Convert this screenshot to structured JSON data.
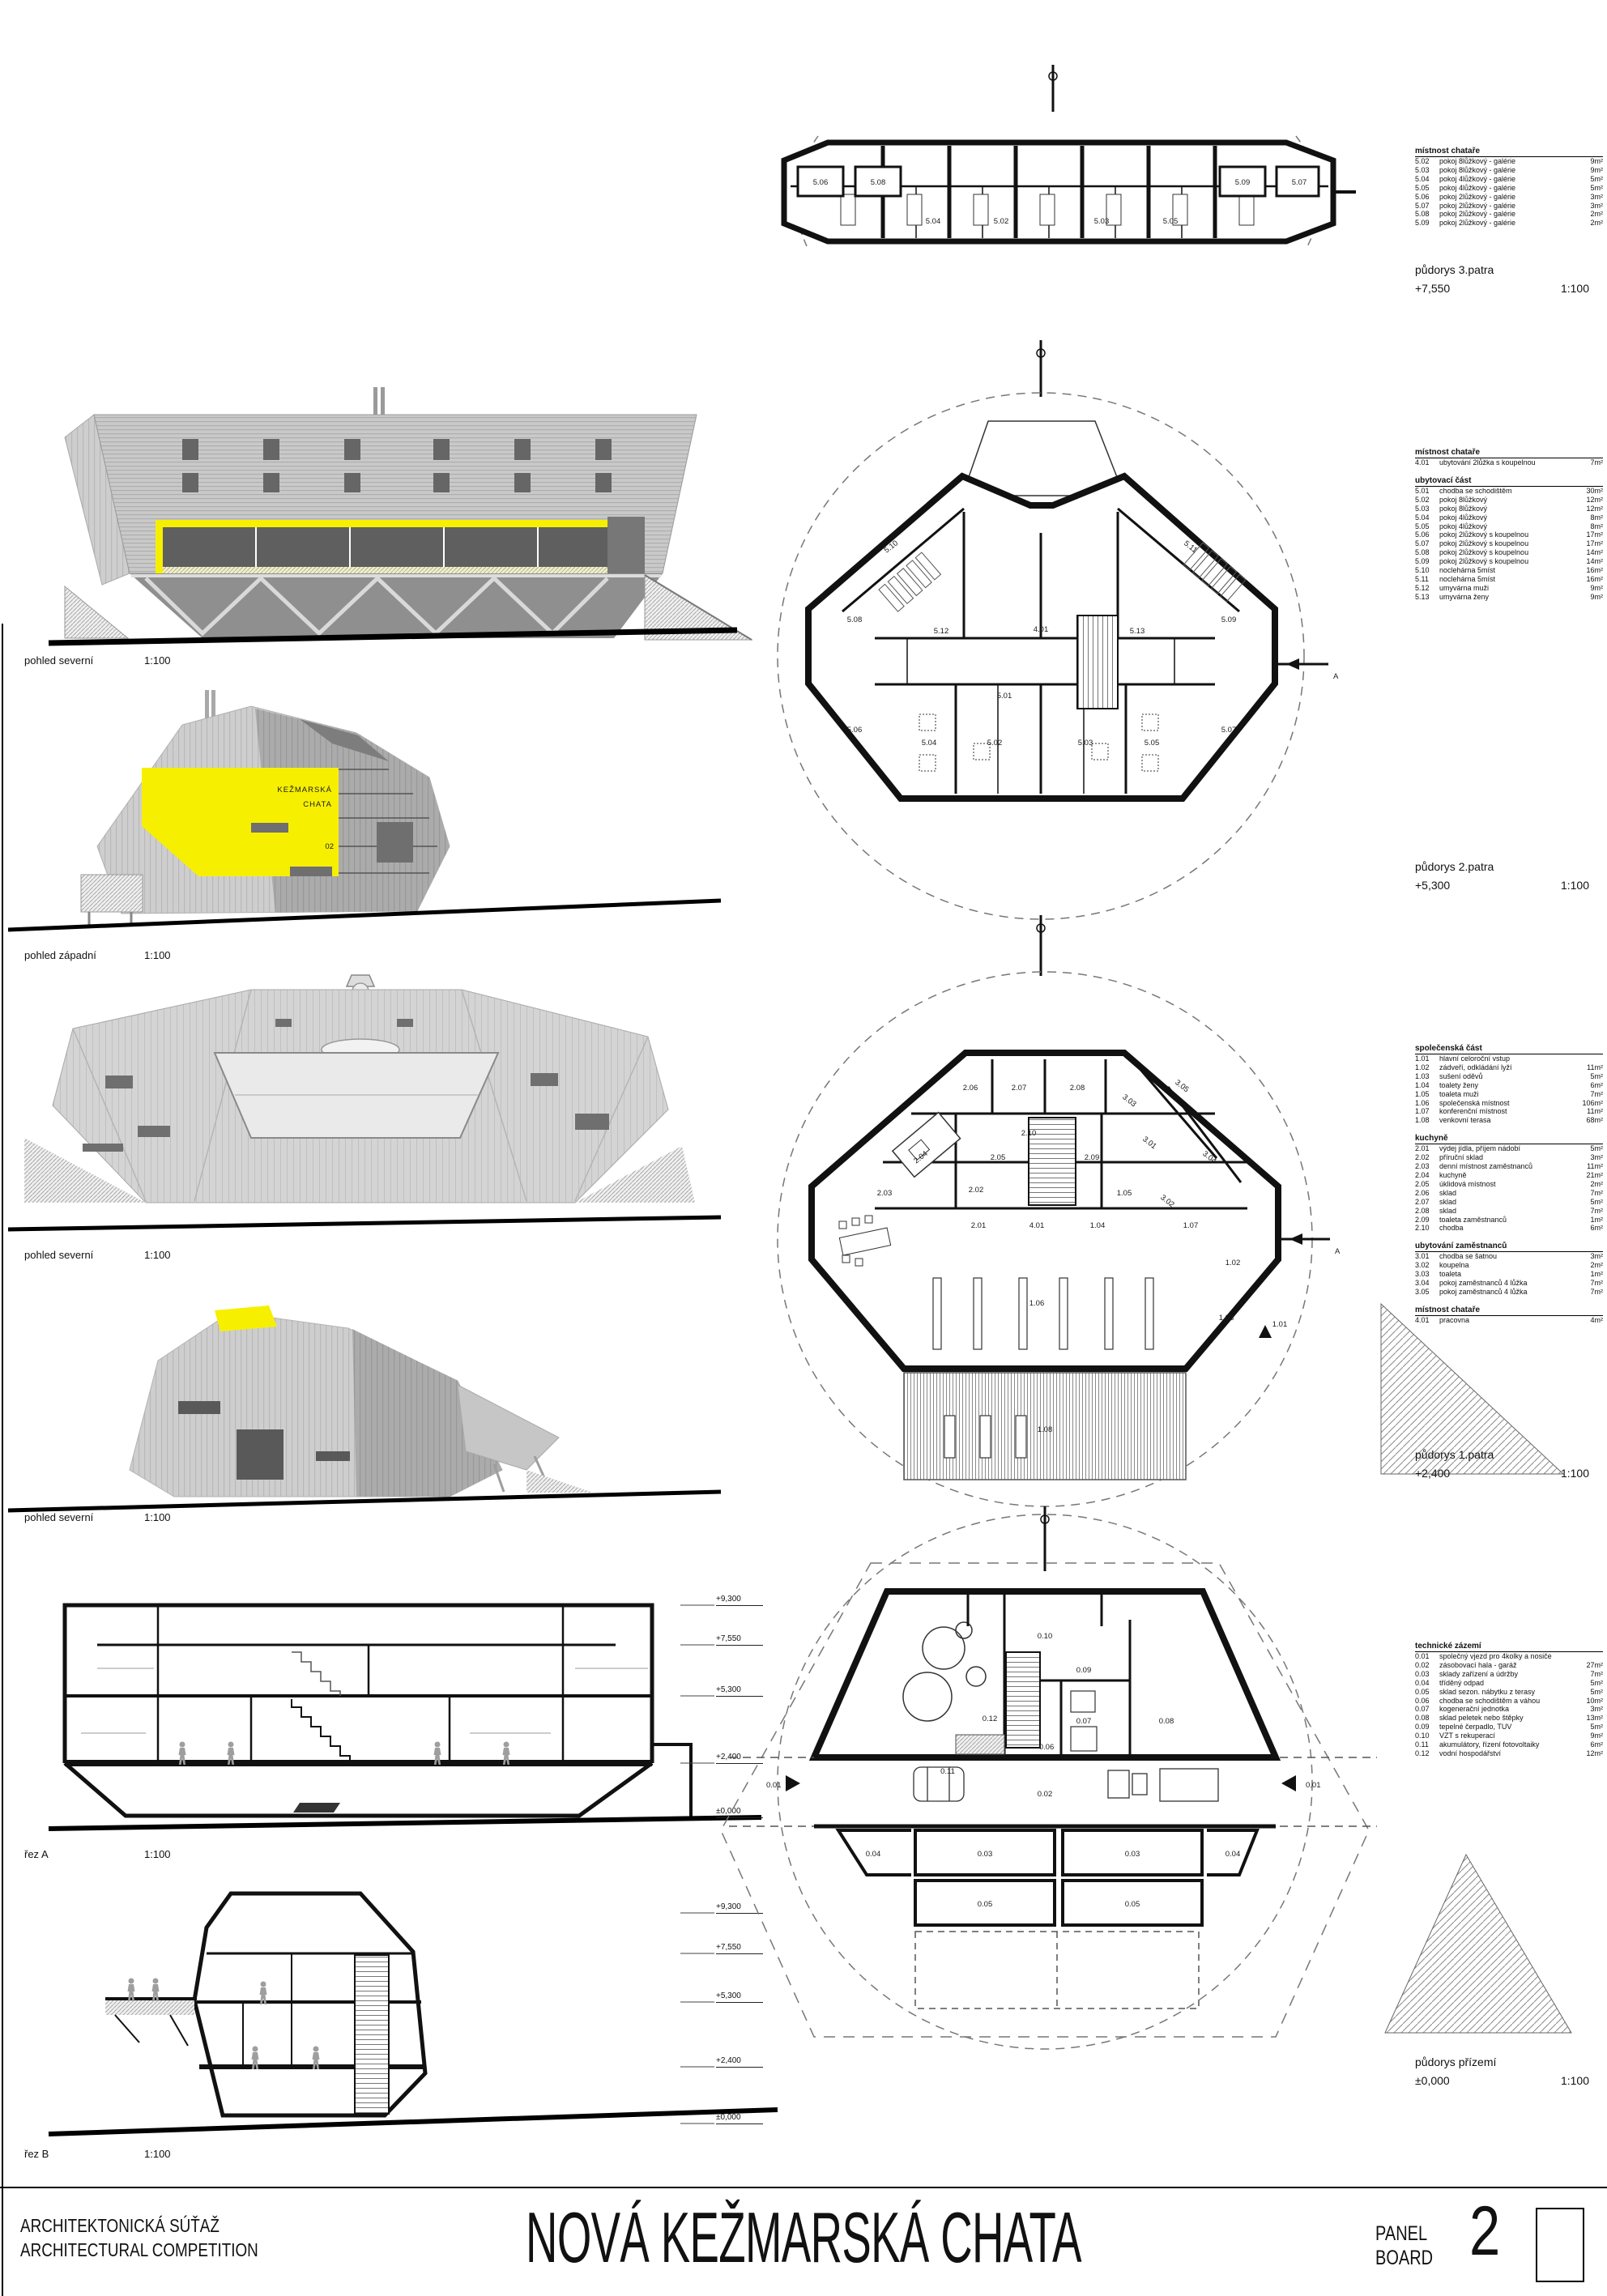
{
  "accent_yellow": "#f7ef00",
  "section_marker": "A",
  "section_levels": [
    "+9,300",
    "+7,550",
    "+5,300",
    "+2,400",
    "±0,000"
  ],
  "building_badge": {
    "line1": "KEŽMARSKÁ",
    "line2": "CHATA",
    "number": "02"
  },
  "views": {
    "elevation_north_1": {
      "label": "pohled severní",
      "scale": "1:100"
    },
    "elevation_west": {
      "label": "pohled západní",
      "scale": "1:100"
    },
    "elevation_north_2": {
      "label": "pohled severní",
      "scale": "1:100"
    },
    "elevation_north_3": {
      "label": "pohled severní",
      "scale": "1:100"
    },
    "section_a": {
      "label": "řez A",
      "scale": "1:100"
    },
    "section_b": {
      "label": "řez B",
      "scale": "1:100"
    }
  },
  "plans": {
    "floor3": {
      "title": "půdorys 3.patra",
      "level": "+7,550",
      "scale": "1:100",
      "rooms": [
        "5.06",
        "5.08",
        "5.04",
        "5.02",
        "5.03",
        "5.05",
        "5.09",
        "5.07"
      ]
    },
    "floor2": {
      "title": "půdorys 2.patra",
      "level": "+5,300",
      "scale": "1:100",
      "rooms": [
        "5.10",
        "5.11",
        "5.08",
        "5.09",
        "5.12",
        "4.01",
        "5.13",
        "5.01",
        "5.06",
        "5.07",
        "5.04",
        "5.02",
        "5.03",
        "5.05"
      ]
    },
    "floor1": {
      "title": "půdorys 1.patra",
      "level": "+2,400",
      "scale": "1:100",
      "rooms": [
        "2.06",
        "2.07",
        "2.08",
        "3.03",
        "3.05",
        "2.10",
        "3.01",
        "2.04",
        "2.05",
        "2.09",
        "3.04",
        "2.02",
        "1.05",
        "3.02",
        "2.03",
        "2.01",
        "4.01",
        "1.04",
        "1.07",
        "1.02",
        "1.06",
        "1.03",
        "1.01",
        "1.08"
      ]
    },
    "ground": {
      "title": "půdorys přízemí",
      "level": "±0,000",
      "scale": "1:100",
      "rooms": [
        "0.10",
        "0.09",
        "0.12",
        "0.07",
        "0.08",
        "0.11",
        "0.06",
        "0.01",
        "0.02",
        "0.01",
        "0.04",
        "0.03",
        "0.03",
        "0.04",
        "0.05",
        "0.05"
      ]
    }
  },
  "tables": {
    "floor3": [
      {
        "heading": "místnost chataře",
        "rows": [
          [
            "5.02",
            "pokoj 8lůžkový - galérie",
            "9m²"
          ],
          [
            "5.03",
            "pokoj 8lůžkový - galérie",
            "9m²"
          ],
          [
            "5.04",
            "pokoj 4lůžkový - galérie",
            "5m²"
          ],
          [
            "5.05",
            "pokoj 4lůžkový - galérie",
            "5m²"
          ],
          [
            "5.06",
            "pokoj 2lůžkový - galérie",
            "3m²"
          ],
          [
            "5.07",
            "pokoj 2lůžkový - galérie",
            "3m²"
          ],
          [
            "5.08",
            "pokoj 2lůžkový - galérie",
            "2m²"
          ],
          [
            "5.09",
            "pokoj 2lůžkový - galérie",
            "2m²"
          ]
        ]
      }
    ],
    "floor2": [
      {
        "heading": "místnost chataře",
        "rows": [
          [
            "4.01",
            "ubytování 2lůžka s koupelnou",
            "7m²"
          ]
        ]
      },
      {
        "heading": "ubytovací část",
        "rows": [
          [
            "5.01",
            "chodba se schodištěm",
            "30m²"
          ],
          [
            "5.02",
            "pokoj 8lůžkový",
            "12m²"
          ],
          [
            "5.03",
            "pokoj 8lůžkový",
            "12m²"
          ],
          [
            "5.04",
            "pokoj 4lůžkový",
            "8m²"
          ],
          [
            "5.05",
            "pokoj 4lůžkový",
            "8m²"
          ],
          [
            "5.06",
            "pokoj 2lůžkový s koupelnou",
            "17m²"
          ],
          [
            "5.07",
            "pokoj 2lůžkový s koupelnou",
            "17m²"
          ],
          [
            "5.08",
            "pokoj 2lůžkový s koupelnou",
            "14m²"
          ],
          [
            "5.09",
            "pokoj 2lůžkový s koupelnou",
            "14m²"
          ],
          [
            "5.10",
            "noclehárna 5míst",
            "16m²"
          ],
          [
            "5.11",
            "noclehárna 5míst",
            "16m²"
          ],
          [
            "5.12",
            "umyvárna muži",
            "9m²"
          ],
          [
            "5.13",
            "umyvárna ženy",
            "9m²"
          ]
        ]
      }
    ],
    "floor1": [
      {
        "heading": "společenská část",
        "rows": [
          [
            "1.01",
            "hlavní celoroční vstup",
            ""
          ],
          [
            "1.02",
            "zádveří, odkládání lyží",
            "11m²"
          ],
          [
            "1.03",
            "sušení oděvů",
            "5m²"
          ],
          [
            "1.04",
            "toalety ženy",
            "6m²"
          ],
          [
            "1.05",
            "toaleta muži",
            "7m²"
          ],
          [
            "1.06",
            "společenská místnost",
            "106m²"
          ],
          [
            "1.07",
            "konferenční místnost",
            "11m²"
          ],
          [
            "1.08",
            "venkovní terasa",
            "68m²"
          ]
        ]
      },
      {
        "heading": "kuchyně",
        "rows": [
          [
            "2.01",
            "výdej jídla, příjem nádobí",
            "5m²"
          ],
          [
            "2.02",
            "příruční sklad",
            "3m²"
          ],
          [
            "2.03",
            "denní místnost zaměstnanců",
            "11m²"
          ],
          [
            "2.04",
            "kuchyně",
            "21m²"
          ],
          [
            "2.05",
            "úklidová místnost",
            "2m²"
          ],
          [
            "2.06",
            "sklad",
            "7m²"
          ],
          [
            "2.07",
            "sklad",
            "5m²"
          ],
          [
            "2.08",
            "sklad",
            "7m²"
          ],
          [
            "2.09",
            "toaleta zaměstnanců",
            "1m²"
          ],
          [
            "2.10",
            "chodba",
            "6m²"
          ]
        ]
      },
      {
        "heading": "ubytování zaměstnanců",
        "rows": [
          [
            "3.01",
            "chodba se šatnou",
            "3m²"
          ],
          [
            "3.02",
            "koupelna",
            "2m²"
          ],
          [
            "3.03",
            "toaleta",
            "1m²"
          ],
          [
            "3.04",
            "pokoj zaměstnanců 4 lůžka",
            "7m²"
          ],
          [
            "3.05",
            "pokoj zaměstnanců 4 lůžka",
            "7m²"
          ]
        ]
      },
      {
        "heading": "místnost chataře",
        "rows": [
          [
            "4.01",
            "pracovna",
            "4m²"
          ]
        ]
      }
    ],
    "ground": [
      {
        "heading": "technické zázemí",
        "rows": [
          [
            "0.01",
            "společný vjezd pro 4kolky a nosiče",
            ""
          ],
          [
            "0.02",
            "zásobovací hala - garáž",
            "27m²"
          ],
          [
            "0.03",
            "sklady zařízení a údržby",
            "7m²"
          ],
          [
            "0.04",
            "tříděný odpad",
            "5m²"
          ],
          [
            "0.05",
            "sklad sezon. nábytku z terasy",
            "5m²"
          ],
          [
            "0.06",
            "chodba se schodištěm a váhou",
            "10m²"
          ],
          [
            "0.07",
            "kogenerační jednotka",
            "3m²"
          ],
          [
            "0.08",
            "sklad peletek nebo štěpky",
            "13m²"
          ],
          [
            "0.09",
            "tepelné čerpadlo, TUV",
            "5m²"
          ],
          [
            "0.10",
            "VZT s rekuperací",
            "9m²"
          ],
          [
            "0.11",
            "akumulátory, řízení fotovoltaiky",
            "6m²"
          ],
          [
            "0.12",
            "vodní hospodářství",
            "12m²"
          ]
        ]
      }
    ]
  },
  "banner": {
    "competition_line1": "ARCHITEKTONICKÁ SÚŤAŽ",
    "competition_line2": "ARCHITECTURAL COMPETITION",
    "project_title": "NOVÁ KEŽMARSKÁ CHATA",
    "panel_line1": "PANEL",
    "panel_line2": "BOARD",
    "panel_number": "2"
  }
}
